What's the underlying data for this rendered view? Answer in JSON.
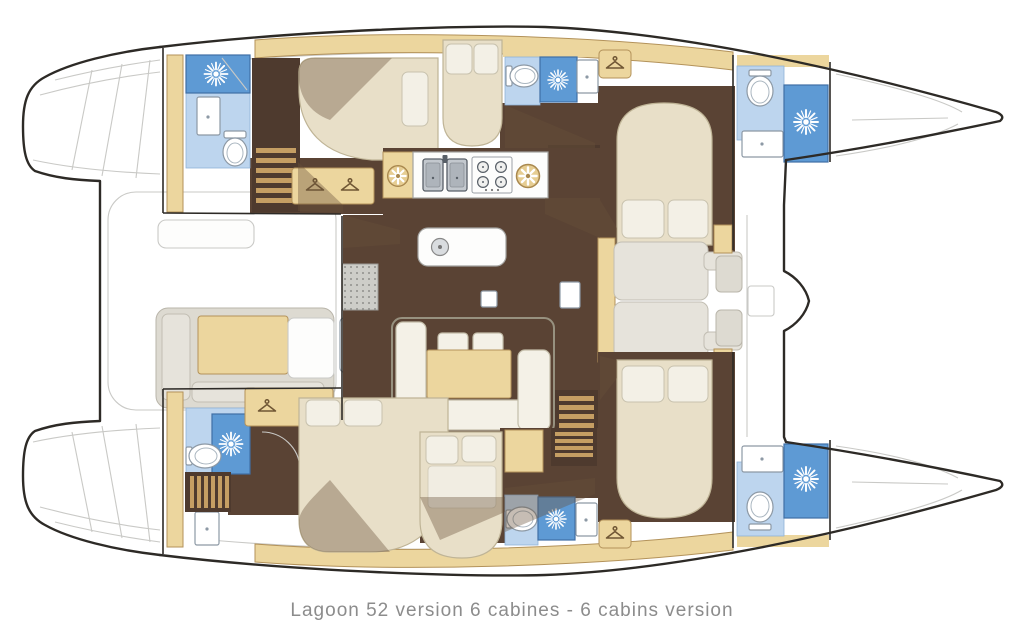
{
  "caption": {
    "text": "Lagoon 52 version 6 cabines - 6 cabins version"
  },
  "palette": {
    "background": "#ffffff",
    "outline": "#2d2a26",
    "ghost_line": "#c9c9c6",
    "wood_tan": "#ecd69e",
    "wood_tan_stroke": "#b3925a",
    "floor_brown": "#5a4334",
    "shadow_brown": "rgba(104,82,58,0.38)",
    "bed_beige": "#e8dfc8",
    "bed_stroke": "#bfb496",
    "shower_blue": "#5e9ad4",
    "bath_blue": "#bdd5ee",
    "fixture_white": "#ffffff",
    "fixture_stroke": "#8d99a5",
    "sofa_cream": "#f4f1e7",
    "seat_gray": "#dddad1",
    "counter_white": "#fdfdfc",
    "stair_dark": "#4e3a2e",
    "stair_slat": "#c59e63",
    "caption_gray": "#8c8c8c"
  },
  "icons": {
    "shower_head": "white sunburst on blue shower tray",
    "toilet": "oval toilet seen from above",
    "wardrobe_hanger": "clothes hanger on wood locker",
    "galley_vent": "round vent fan with white spokes",
    "double_sink": "twin gray basins with faucet",
    "stove": "four burner cooktop",
    "floor_mat": "perforated gray entry mat"
  }
}
